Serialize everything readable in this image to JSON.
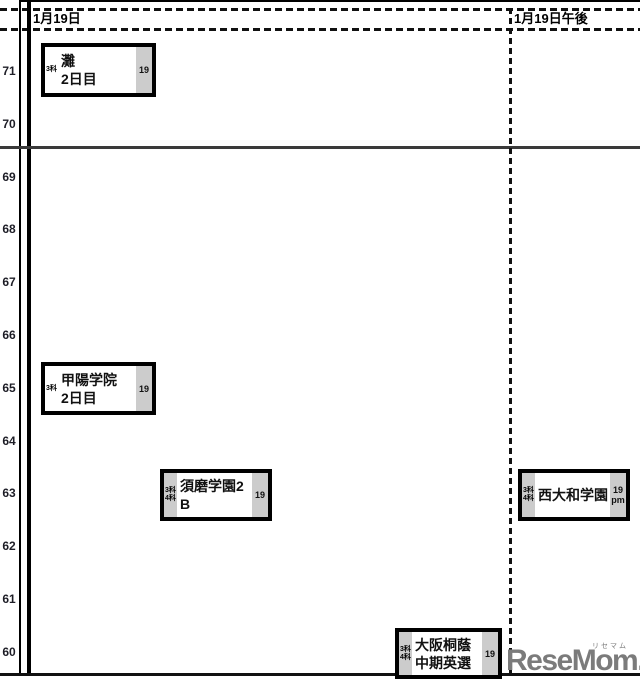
{
  "page": {
    "columns": [
      {
        "label": "1月19日"
      },
      {
        "label": "1月19日午後"
      }
    ],
    "axis": {
      "values": [
        "71",
        "70",
        "69",
        "68",
        "67",
        "66",
        "65",
        "64",
        "63",
        "62",
        "61",
        "60"
      ]
    },
    "boxes": [
      {
        "name": "灘",
        "line2": "2日目",
        "subj1": "3科",
        "subj2": "",
        "date": "19",
        "date2": ""
      },
      {
        "name": "甲陽学院",
        "line2": "2日目",
        "subj1": "3科",
        "subj2": "",
        "date": "19",
        "date2": ""
      },
      {
        "name": "須磨学園2",
        "line2": "B",
        "subj1": "3科",
        "subj2": "4科",
        "date": "19",
        "date2": ""
      },
      {
        "name": "西大和学園",
        "line2": "",
        "subj1": "3科",
        "subj2": "4科",
        "date": "19",
        "date2": "pm"
      },
      {
        "name": "大阪桐蔭",
        "line2": "中期英選",
        "subj1": "3科",
        "subj2": "4科",
        "date": "19",
        "date2": ""
      }
    ],
    "logo": {
      "text": "ReseMom.",
      "ruby": "リセマム"
    },
    "colors": {
      "grid_line": "#000000",
      "box_strip_gray": "#cccccc",
      "logo_gray": "#7b7b7b"
    }
  },
  "chart_data": {
    "type": "scatter",
    "title": "",
    "xlabel": "",
    "ylabel": "",
    "y_axis_ticks": [
      71,
      70,
      69,
      68,
      67,
      66,
      65,
      64,
      63,
      62,
      61,
      60
    ],
    "ylim": [
      60,
      71
    ],
    "columns": [
      "1月19日",
      "1月19日午後"
    ],
    "grid": "dashed header band, solid divider between 70 and 69, solid bottom line",
    "legend": "none",
    "points": [
      {
        "label": "灘 2日目",
        "column": "1月19日",
        "y": 71,
        "subjects": "3科",
        "badge": "19"
      },
      {
        "label": "甲陽学院 2日目",
        "column": "1月19日",
        "y": 65,
        "subjects": "3科",
        "badge": "19"
      },
      {
        "label": "須磨学園2 B",
        "column": "1月19日",
        "y": 63,
        "subjects": "3科・4科",
        "badge": "19"
      },
      {
        "label": "西大和学園",
        "column": "1月19日午後",
        "y": 63,
        "subjects": "3科・4科",
        "badge": "19 pm"
      },
      {
        "label": "大阪桐蔭 中期英選",
        "column": "1月19日",
        "y": 60,
        "subjects": "3科・4科",
        "badge": "19"
      }
    ],
    "watermark": "ReseMom. (リセマム)"
  }
}
